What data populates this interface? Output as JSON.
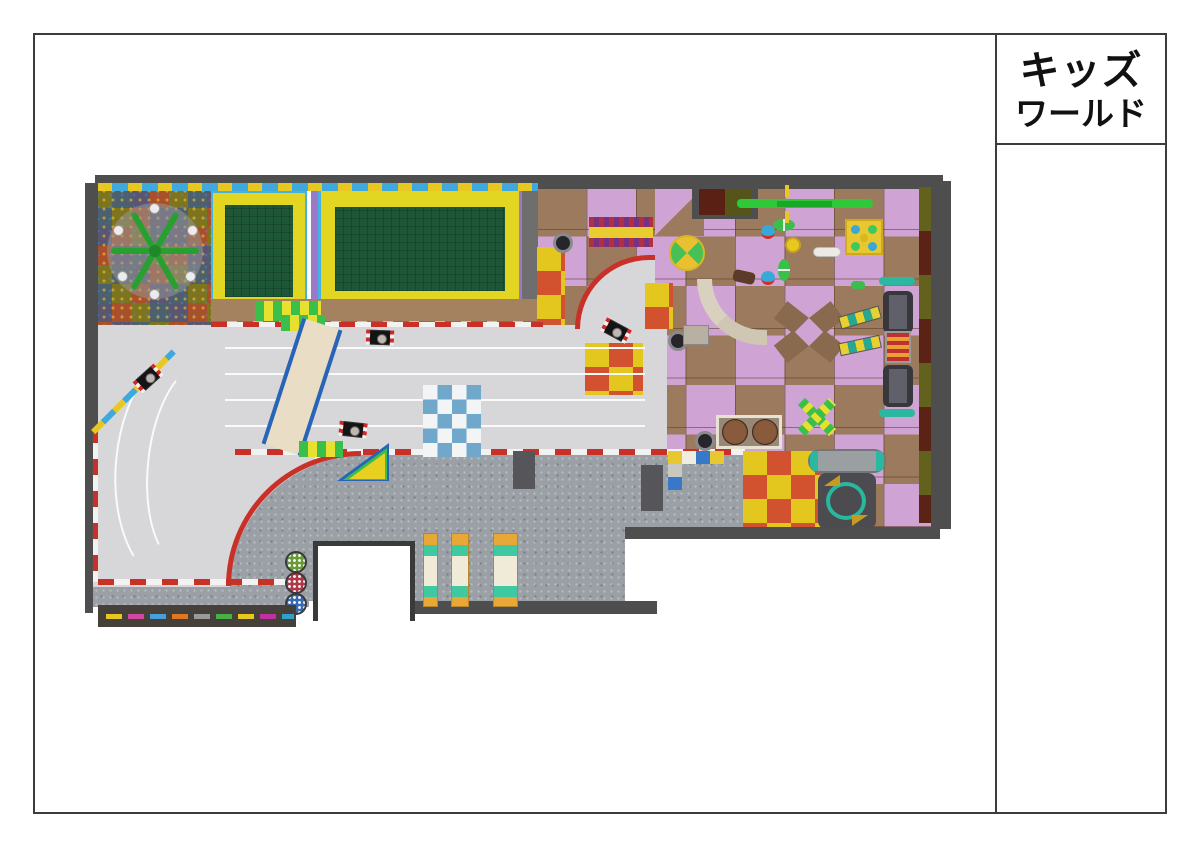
{
  "title_block": {
    "line1": "キッズ",
    "line2": "ワールド"
  },
  "plan": {
    "karts_on_track": 4,
    "trampolines": 2,
    "bench_lockers": 3,
    "stools": 3
  },
  "palette": {
    "wall": "#4e4e4e",
    "track_surface": "#d7d7d9",
    "track_curb_red": "#c83028",
    "infield_carpet": "#9aa0a5",
    "patchwork_carpet_red": "#a8502a",
    "patchwork_carpet_olive": "#7d7420",
    "trampoline_bed_green": "#1d5737",
    "trampoline_frame_yellow": "#e3d622",
    "trampoline_edge_blue": "#45b2e2",
    "play_cell_pink": "#cfa3d4",
    "play_cell_brown": "#9b7a5e",
    "mat_red": "#d2512e",
    "mat_yellow": "#e3c61e",
    "crosswalk_blue": "#6fa8cb",
    "zipline_green": "#2ec838",
    "bridge_edge_blue": "#2864b8",
    "locker_orange": "#e8a838",
    "locker_teal": "#40c8a0"
  }
}
